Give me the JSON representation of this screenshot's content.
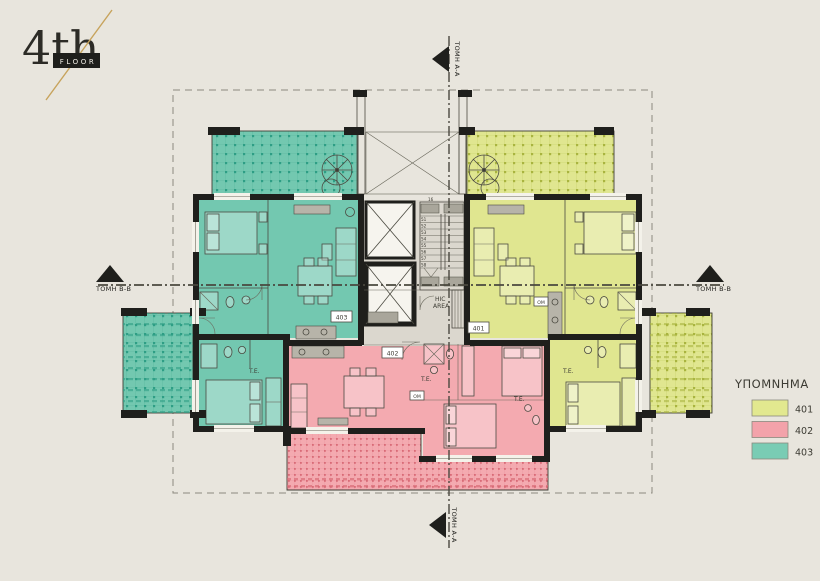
{
  "logo": {
    "number": "4th",
    "label": "FLOOR"
  },
  "legend": {
    "title": "ΥΠΟΜΝΗΜΑ",
    "items": [
      {
        "label": "401",
        "color": "#e2e88f"
      },
      {
        "label": "402",
        "color": "#f3a2aa"
      },
      {
        "label": "403",
        "color": "#79ccb4"
      }
    ]
  },
  "sections": {
    "aa": "ΤΟΜΗ Α-Α",
    "bb": "ΤΟΜΗ Β-Β"
  },
  "units": {
    "u401": "401",
    "u402": "402",
    "u403": "403"
  },
  "labels": {
    "te": "T.E.",
    "om": "OM",
    "hic1": "HIC",
    "hic2": "AREA",
    "stair_top": "16"
  },
  "stairs": {
    "steps": [
      "51",
      "52",
      "53",
      "54",
      "55",
      "56",
      "57",
      "58"
    ]
  },
  "colors": {
    "background": "#e8e5dd",
    "ink": "#3c3b33",
    "wall": "#1f1f1c",
    "teal": "#73c8b0",
    "teal_grid": "#52b299",
    "teal_dark": "#2e9e85",
    "yellow": "#e0e690",
    "yellow_grid": "#c3cc62",
    "yellow_dark": "#a9b43f",
    "pink": "#f4aab0",
    "pink_grid": "#e78e97",
    "pink_dark": "#d96b77",
    "core": "#dbd7ce",
    "gold": "#c7a35c"
  }
}
